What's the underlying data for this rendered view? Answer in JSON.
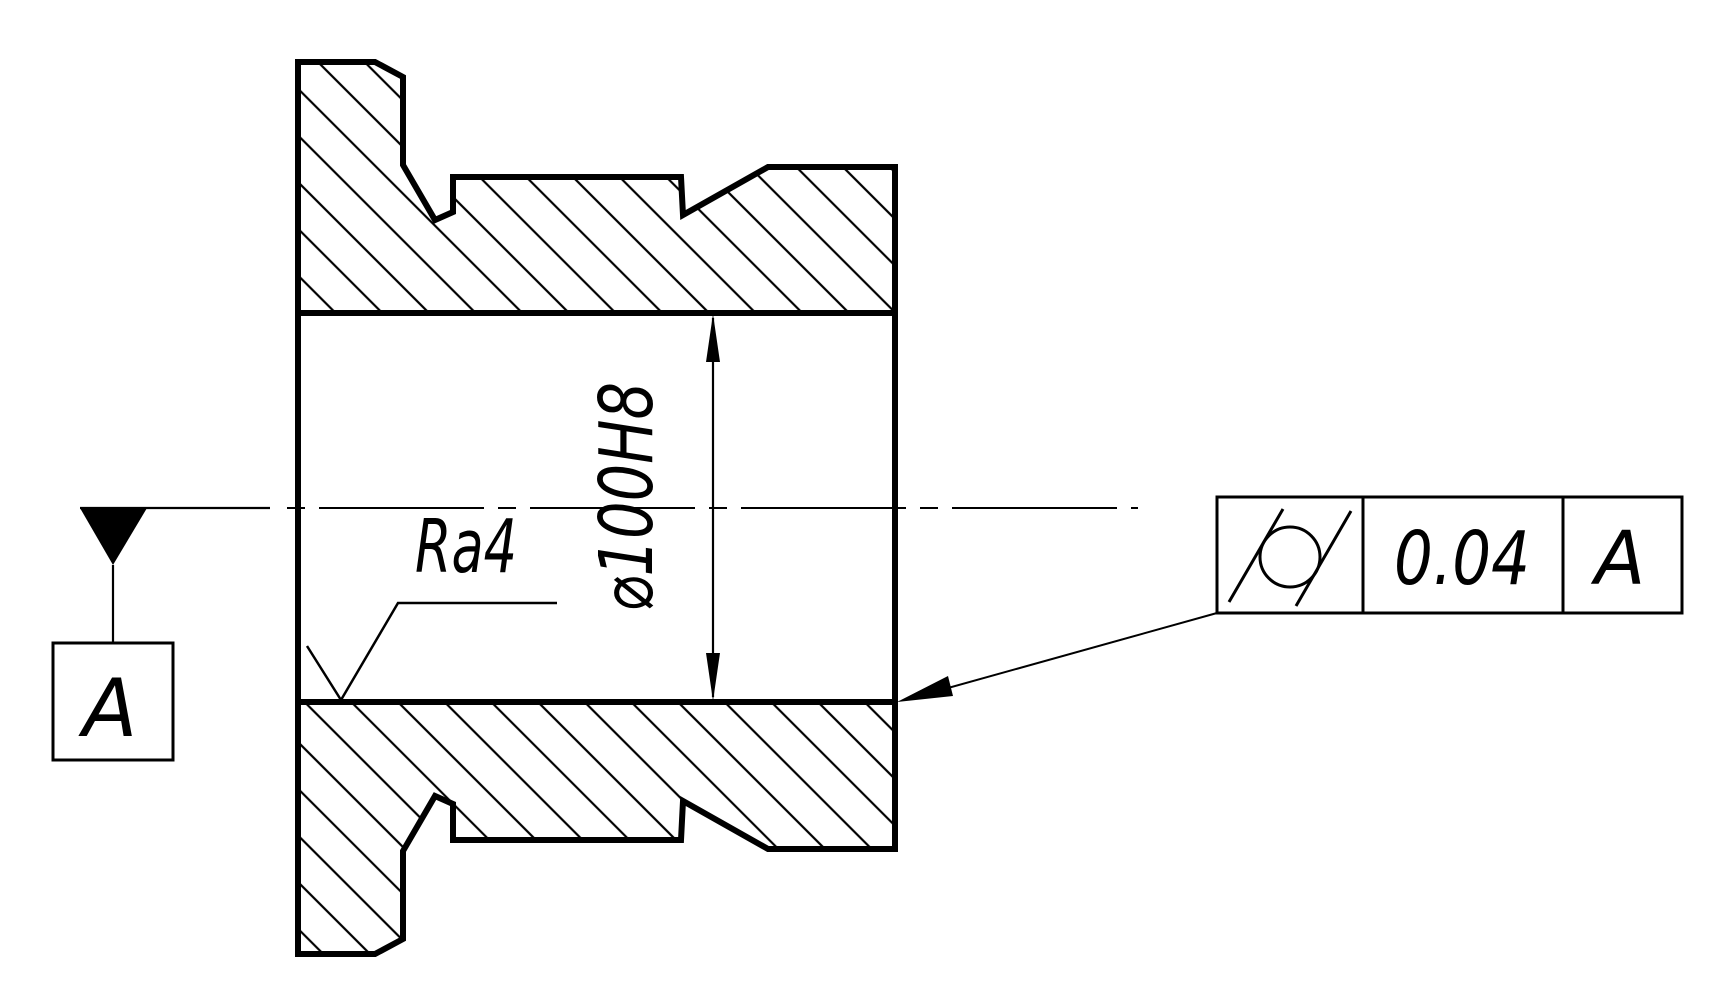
{
  "drawing": {
    "type": "engineering-section-view",
    "part": "flanged bushing, full section with hatching",
    "dimension": {
      "label": "⌀100H8",
      "applies_to": "bore diameter"
    },
    "surface_finish": {
      "label": "Ra4",
      "applies_to": "bore surface"
    },
    "datum": {
      "label": "A",
      "symbol": "filled-triangle on centerline with boxed letter"
    },
    "feature_control_frame": {
      "symbol_name": "cylindricity",
      "tolerance": "0.04",
      "datum_ref": "A",
      "applies_to": "bore surface via leader arrow"
    },
    "colors": {
      "ink": "#000000",
      "paper": "#ffffff"
    }
  }
}
